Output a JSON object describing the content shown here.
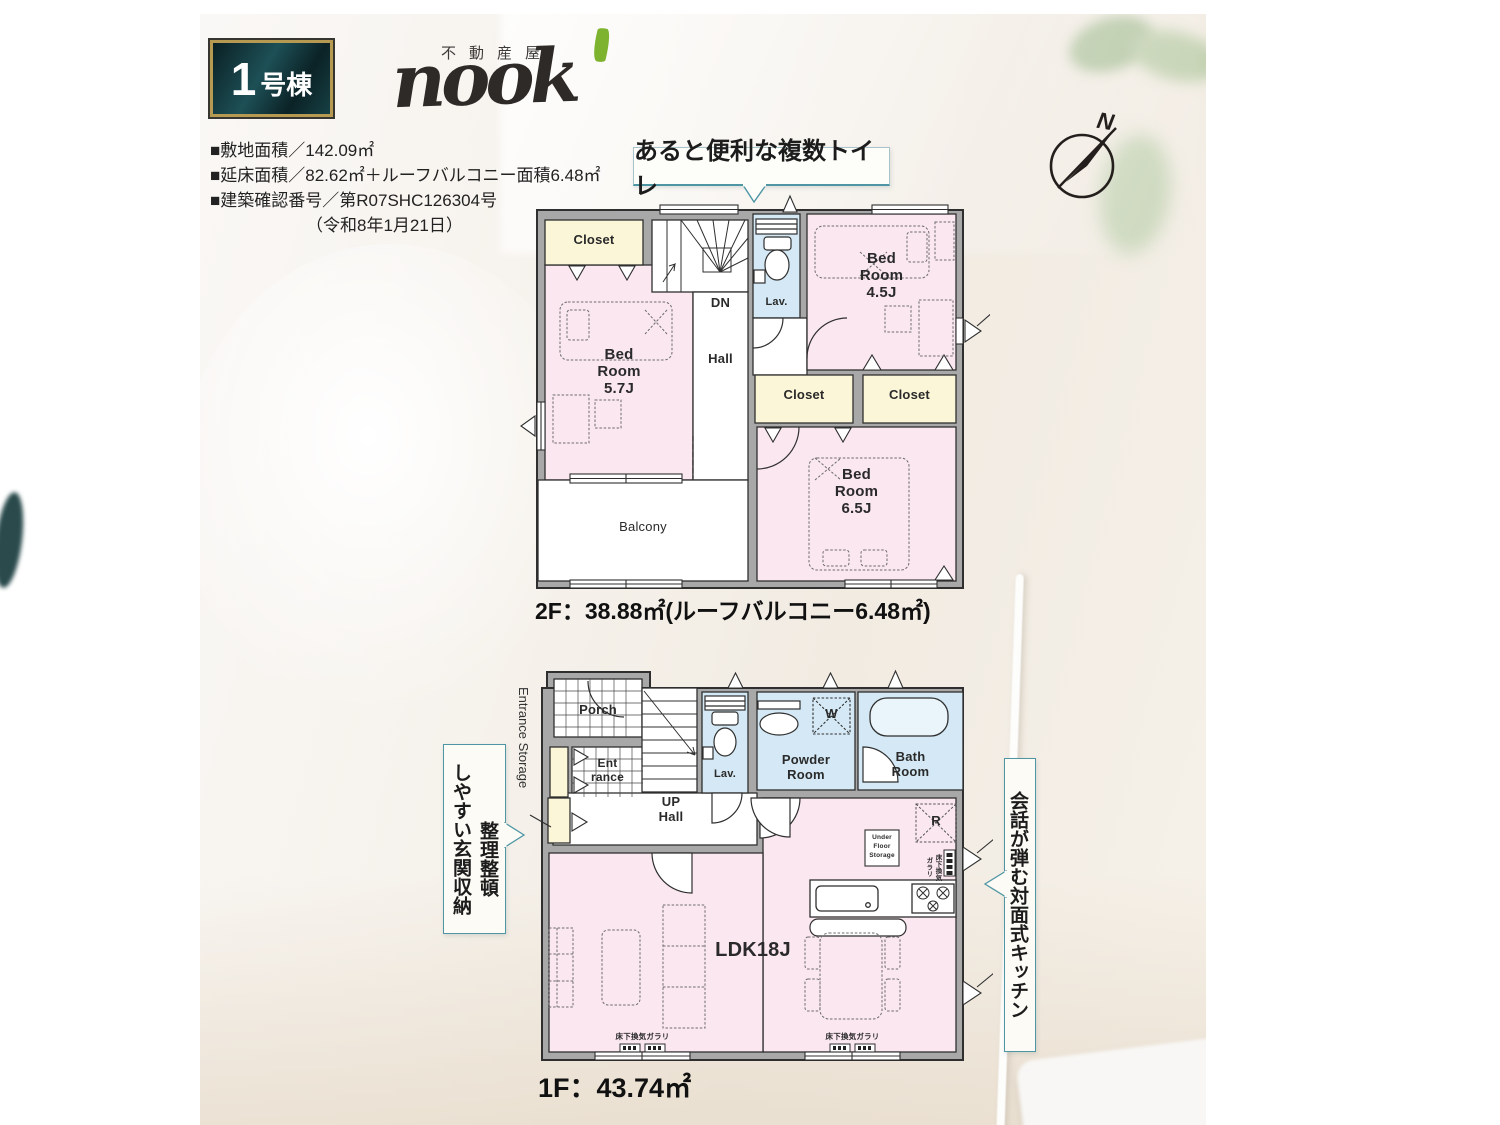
{
  "header": {
    "badge_num": "1",
    "badge_suffix": "号棟",
    "logo_tagline": "不動産屋",
    "logo_brand": "nook",
    "info_line1": "■敷地面積／142.09㎡",
    "info_line2": "■延床面積／82.62㎡＋ルーフバルコニー面積6.48㎡",
    "info_line3": "■建築確認番号／第R07SHC126304号",
    "info_line4": "（令和8年1月21日）",
    "compass_n": "N"
  },
  "callouts": {
    "toilet": "あると便利な複数トイレ",
    "entrance_line1": "整理整頓",
    "entrance_line2": "しやすい玄関収納",
    "kitchen": "会話が弾む対面式キッチン"
  },
  "floor2": {
    "area_label": "2F：38.88㎡(ルーフバルコニー6.48㎡)",
    "rooms": {
      "closet_tl": "Closet",
      "dn": "DN",
      "hall": "Hall",
      "lav": "Lav.",
      "bed45": "Bed\nRoom\n4.5J",
      "bed57": "Bed\nRoom\n5.7J",
      "closet1": "Closet",
      "closet2": "Closet",
      "bed65": "Bed\nRoom\n6.5J",
      "balcony": "Balcony"
    }
  },
  "floor1": {
    "area_label": "1F：43.74㎡",
    "side_label": "Entrance Storage",
    "rooms": {
      "porch": "Porch",
      "entrance": "Ent\nrance",
      "up_hall": "UP\nHall",
      "lav": "Lav.",
      "powder": "Powder\nRoom",
      "washer": "W",
      "bath": "Bath\nRoom",
      "fridge": "R",
      "under_floor": "Under\nFloor\nStorage",
      "ldk": "LDK18J",
      "vent_bottom_left": "床下換気ガラリ",
      "vent_bottom_right": "床下換気ガラリ",
      "vent_right": "床下換気\nガラリ"
    }
  },
  "colors": {
    "accent_teal": "#4f96a4",
    "room_pink": "#fbe7f0",
    "closet_cream": "#fcf6d9",
    "wet_blue": "#d4e9f5",
    "wall_gray": "#a8a8a8",
    "badge_gold": "#b69a52",
    "leaf_green": "#7db32e"
  }
}
